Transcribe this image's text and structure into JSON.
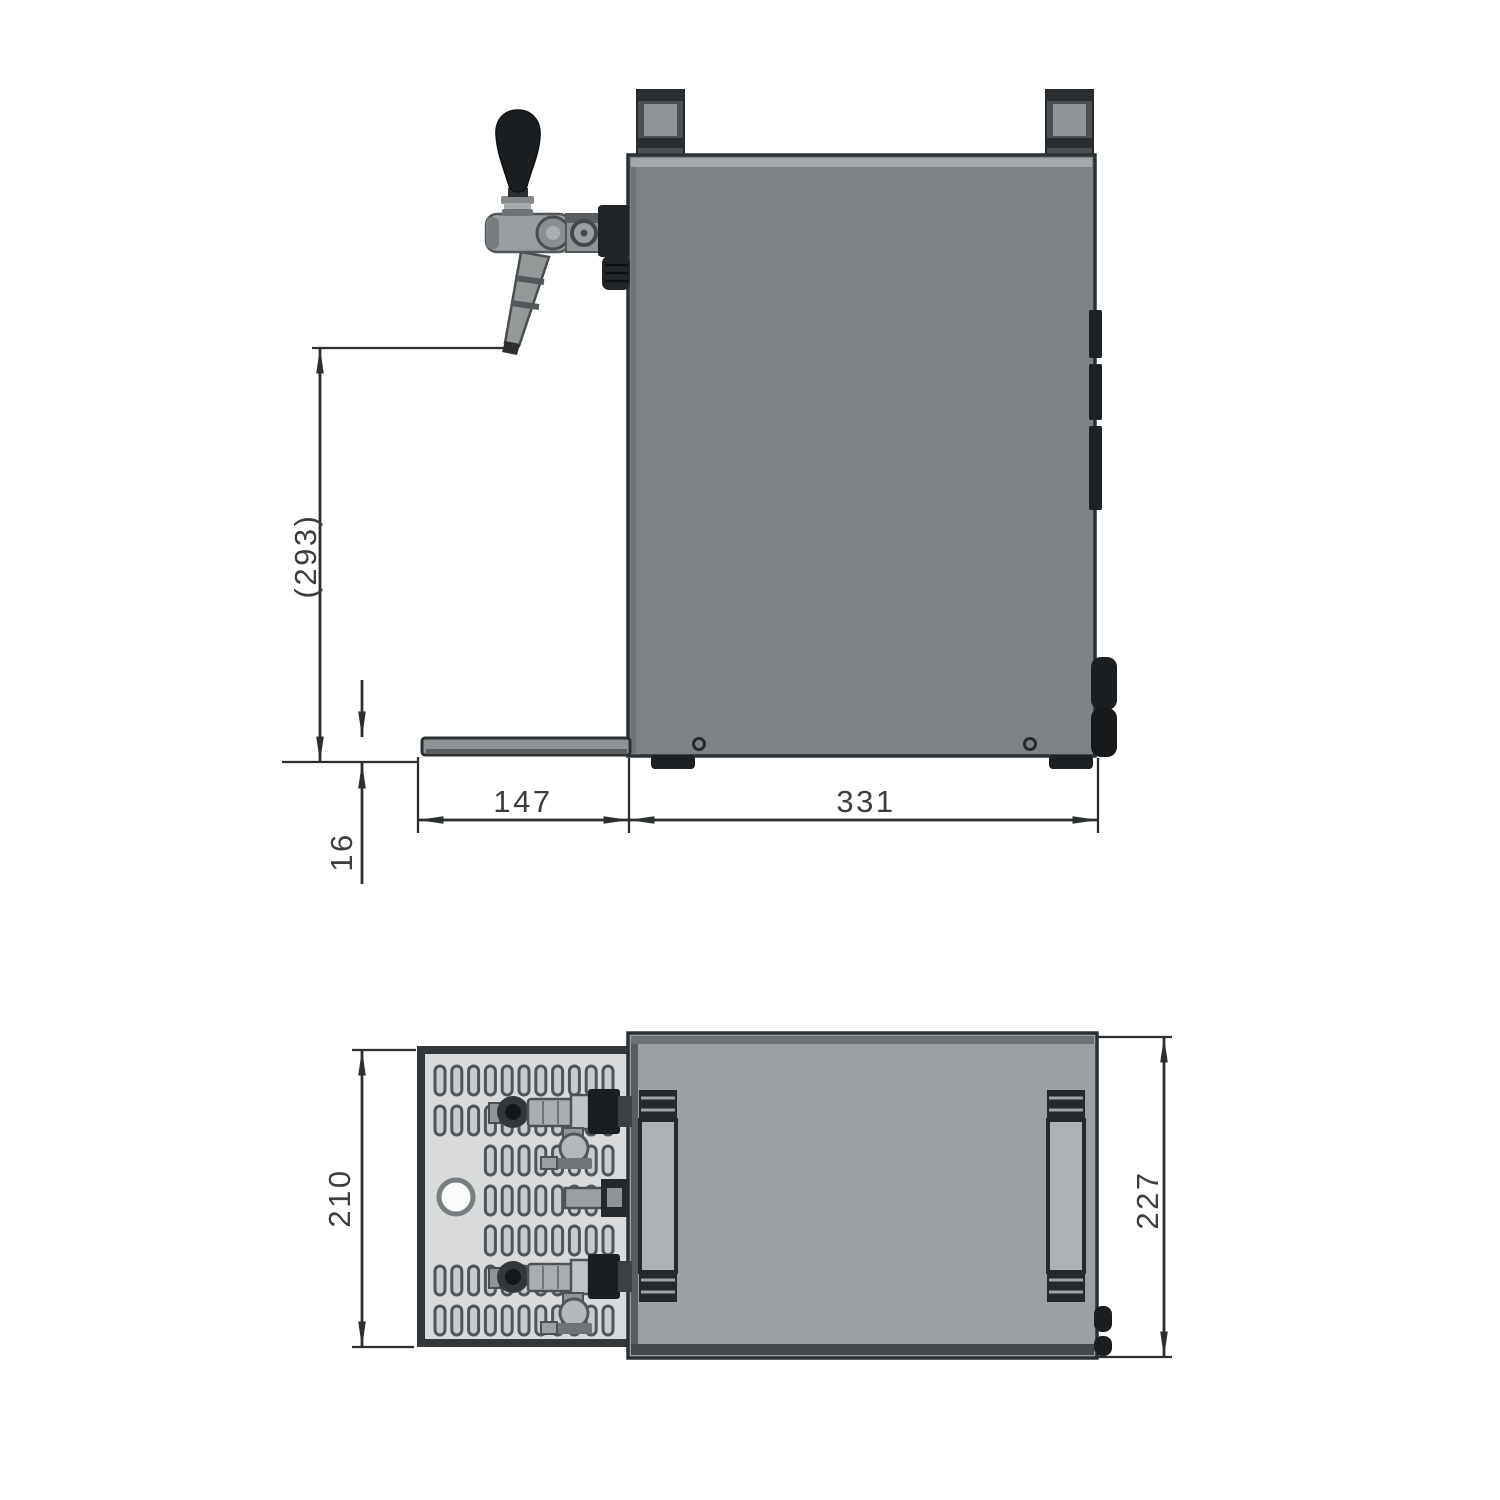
{
  "document": {
    "type": "technical-dimension-drawing",
    "subject": "flow-cooler beer dispenser with tap, drip tray and carrying handles",
    "background": "#ffffff",
    "views": [
      {
        "id": "side",
        "name": "side-view"
      },
      {
        "id": "top",
        "name": "top-view"
      }
    ]
  },
  "dims": {
    "d293": {
      "label": "(293)",
      "value": 293,
      "orientation": "vertical",
      "view": "side"
    },
    "d16": {
      "label": "16",
      "value": 16,
      "orientation": "vertical",
      "view": "side"
    },
    "d147": {
      "label": "147",
      "value": 147,
      "orientation": "horizontal",
      "view": "side"
    },
    "d331": {
      "label": "331",
      "value": 331,
      "orientation": "horizontal",
      "view": "side"
    },
    "d210": {
      "label": "210",
      "value": 210,
      "orientation": "vertical",
      "view": "top"
    },
    "d227": {
      "label": "227",
      "value": 227,
      "orientation": "vertical",
      "view": "top"
    }
  },
  "colors": {
    "line": "#2c2f31",
    "dim_text": "#3b3e41",
    "body_side": "#7d8386",
    "body_side_highlight": "#a3a8ab",
    "body_top_view": "#9ba0a3",
    "tray_side": "#8d9295",
    "tray_top_plate": "#d8dadb",
    "slot_fill": "#c9ccce",
    "slot_stroke": "#515558",
    "dark_parts": "#1b1e20",
    "metal_light": "#999ea1",
    "background": "#ffffff"
  }
}
